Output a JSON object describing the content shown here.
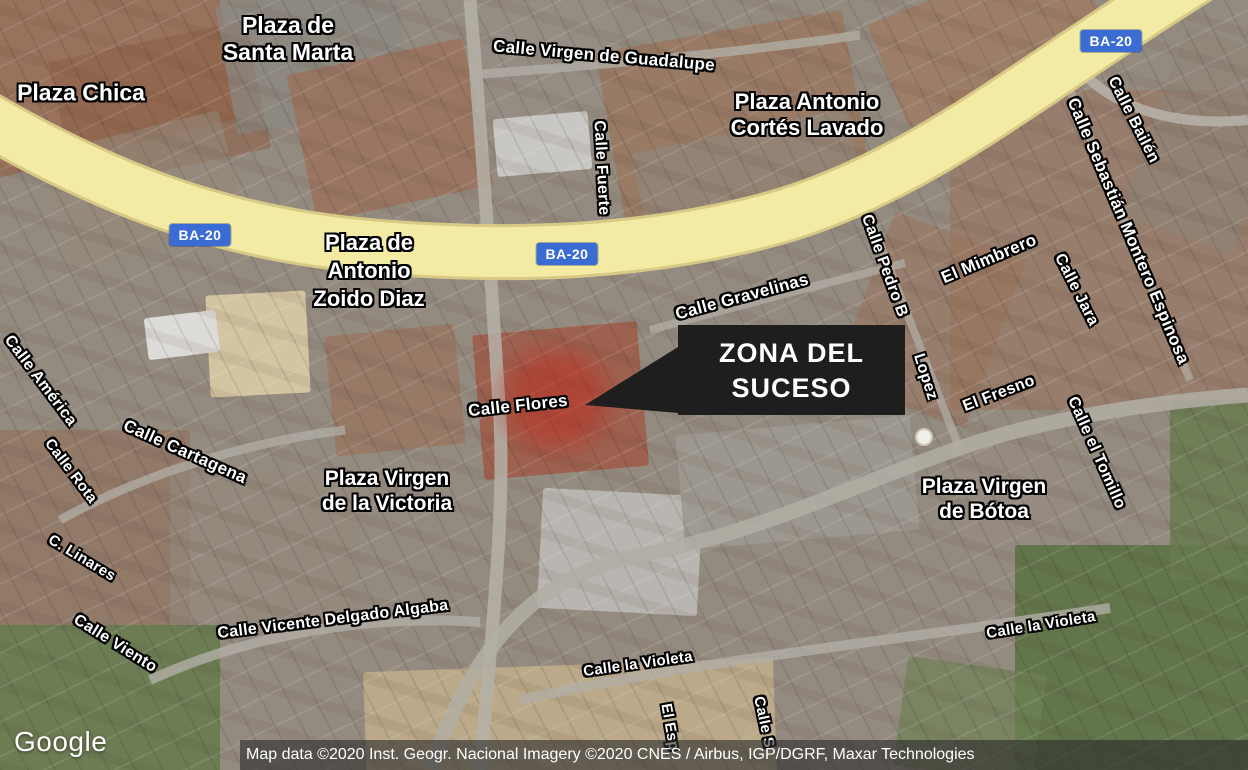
{
  "map": {
    "logo": "Google",
    "attribution": "Map data ©2020 Inst. Geogr. Nacional Imagery ©2020 CNES / Airbus, IGP/DGRF, Maxar Technologies",
    "road_shield": "BA-20",
    "callout": {
      "line1": "ZONA DEL",
      "line2": "SUCESO"
    }
  },
  "labels": {
    "plazas": [
      {
        "name": "plaza-de-santa-marta",
        "lines": [
          "Plaza de",
          "Santa Marta"
        ]
      },
      {
        "name": "plaza-chica",
        "lines": [
          "Plaza Chica"
        ]
      },
      {
        "name": "plaza-antonio-cortes-lavado",
        "lines": [
          "Plaza Antonio",
          "Cortés Lavado"
        ]
      },
      {
        "name": "plaza-de-antonio-zoido-diaz",
        "lines": [
          "Plaza de",
          "Antonio",
          "Zoido Diaz"
        ]
      },
      {
        "name": "plaza-virgen-de-la-victoria",
        "lines": [
          "Plaza Virgen",
          "de la Victoria"
        ]
      },
      {
        "name": "plaza-virgen-de-botoa",
        "lines": [
          "Plaza Virgen",
          "de Bótoa"
        ]
      }
    ],
    "streets": [
      {
        "name": "calle-virgen-de-guadalupe",
        "text": "Calle Virgen de Guadalupe"
      },
      {
        "name": "calle-fuerte",
        "text": "Calle Fuerte"
      },
      {
        "name": "calle-gravelinas",
        "text": "Calle Gravelinas"
      },
      {
        "name": "el-mimbrero",
        "text": "El Mimbrero"
      },
      {
        "name": "calle-pedro-b",
        "text": "Calle Pedro B"
      },
      {
        "name": "lopez",
        "text": "Lopez"
      },
      {
        "name": "calle-bailen",
        "text": "Calle Bailén"
      },
      {
        "name": "calle-sebastian-montero-espinosa",
        "text": "Calle Sebastián Montero Espinosa"
      },
      {
        "name": "calle-jara",
        "text": "Calle Jara"
      },
      {
        "name": "el-fresno",
        "text": "El Fresno"
      },
      {
        "name": "calle-el-tomillo",
        "text": "Calle el Tomillo"
      },
      {
        "name": "calle-flores",
        "text": "Calle Flores"
      },
      {
        "name": "calle-america",
        "text": "Calle América"
      },
      {
        "name": "calle-rota",
        "text": "Calle Rota"
      },
      {
        "name": "calle-cartagena",
        "text": "Calle Cartagena"
      },
      {
        "name": "c-linares",
        "text": "C. Linares"
      },
      {
        "name": "calle-viento",
        "text": "Calle Viento"
      },
      {
        "name": "calle-vicente-delgado-algaba",
        "text": "Calle Vicente Delgado Algaba"
      },
      {
        "name": "calle-la-violeta-west",
        "text": "Calle la Violeta"
      },
      {
        "name": "calle-la-violeta-east",
        "text": "Calle la Violeta"
      },
      {
        "name": "el-esp",
        "text": "El Esp"
      },
      {
        "name": "calle-s",
        "text": "Calle S"
      }
    ]
  },
  "colors": {
    "highway_yellow": "#f3eba3",
    "shield_blue": "#3b6cd4",
    "callout_bg": "#1e1e1e",
    "zone_red": "#c0281c",
    "label_white": "#ffffff"
  }
}
